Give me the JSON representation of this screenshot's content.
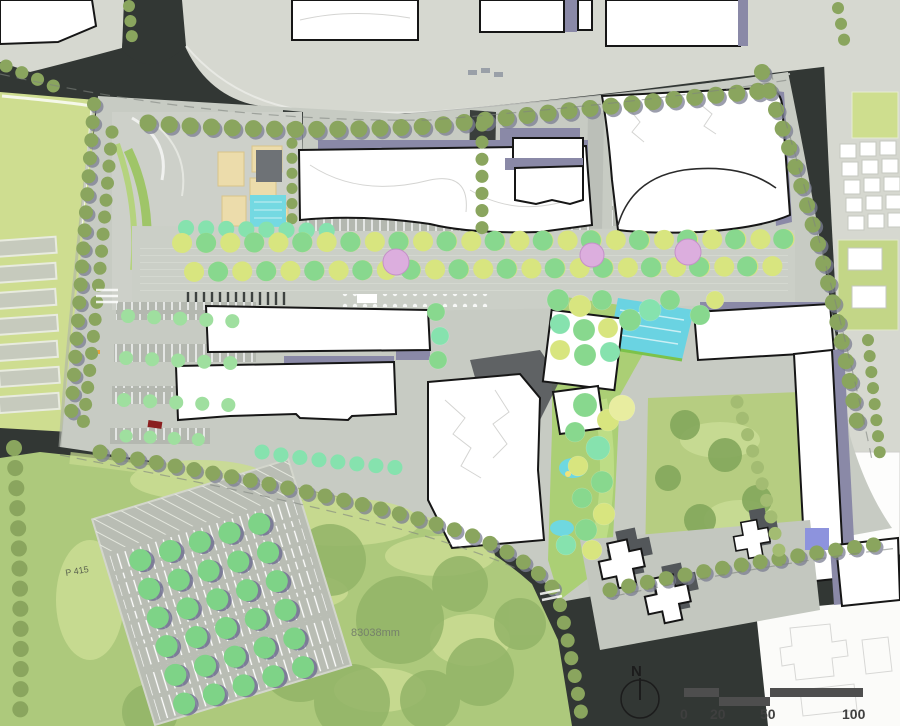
{
  "map": {
    "north_label": "N",
    "scale_ticks": [
      "0",
      "20",
      "50",
      "100"
    ],
    "dimension_annotation": "83038mm",
    "parking_area_label": "P 415"
  },
  "palette": {
    "road_dark": "#323734",
    "context_gray": "#d6d8d0",
    "site_paving": "#c7cbc3",
    "plaza_paving": "#cdd0c9",
    "building_white": "#ffffff",
    "building_outline": "#161616",
    "podium_purple": "#8a89a7",
    "cast_shadow": "#53575a",
    "lawn_green": "#adc97c",
    "lawn_light": "#c9db92",
    "field_green": "#cedd90",
    "courtyard_green": "#b6cd81",
    "tree_green": "#88d88e",
    "tree_yellow": "#d8e57f",
    "tree_mint": "#86e2ae",
    "tree_olive": "#8aa55e",
    "flowering_pink": "#dcaede",
    "water_cyan": "#6ad3e2",
    "plaza_tan": "#ecdcab",
    "scale_bar": "#4e4e4e"
  }
}
